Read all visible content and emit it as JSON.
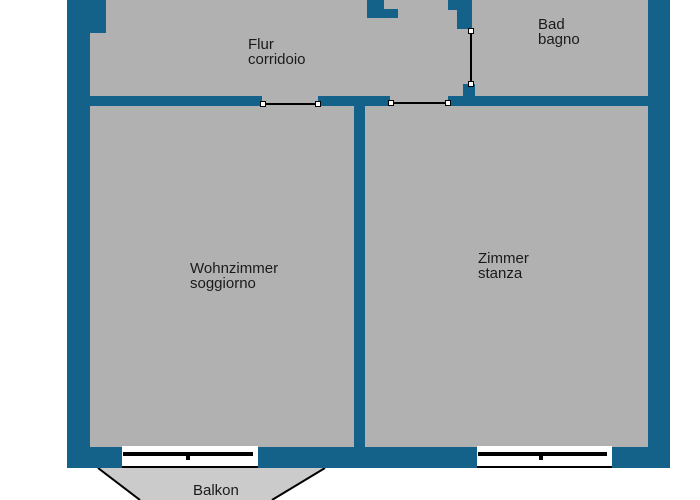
{
  "title": "Apartment floor plan",
  "colors": {
    "wall": "#14618a",
    "floor": "#b1b1b1",
    "balcony": "#cbcbcb",
    "line": "#000000",
    "text": "#1a1a1a",
    "bg": "#ffffff"
  },
  "rooms": {
    "flur": {
      "name_de": "Flur",
      "name_it": "corridoio"
    },
    "bad": {
      "name_de": "Bad",
      "name_it": "bagno"
    },
    "wohnzimmer": {
      "name_de": "Wohnzimmer",
      "name_it": "soggiorno"
    },
    "zimmer": {
      "name_de": "Zimmer",
      "name_it": "stanza"
    },
    "balkon": {
      "name_de": "Balkon"
    }
  }
}
